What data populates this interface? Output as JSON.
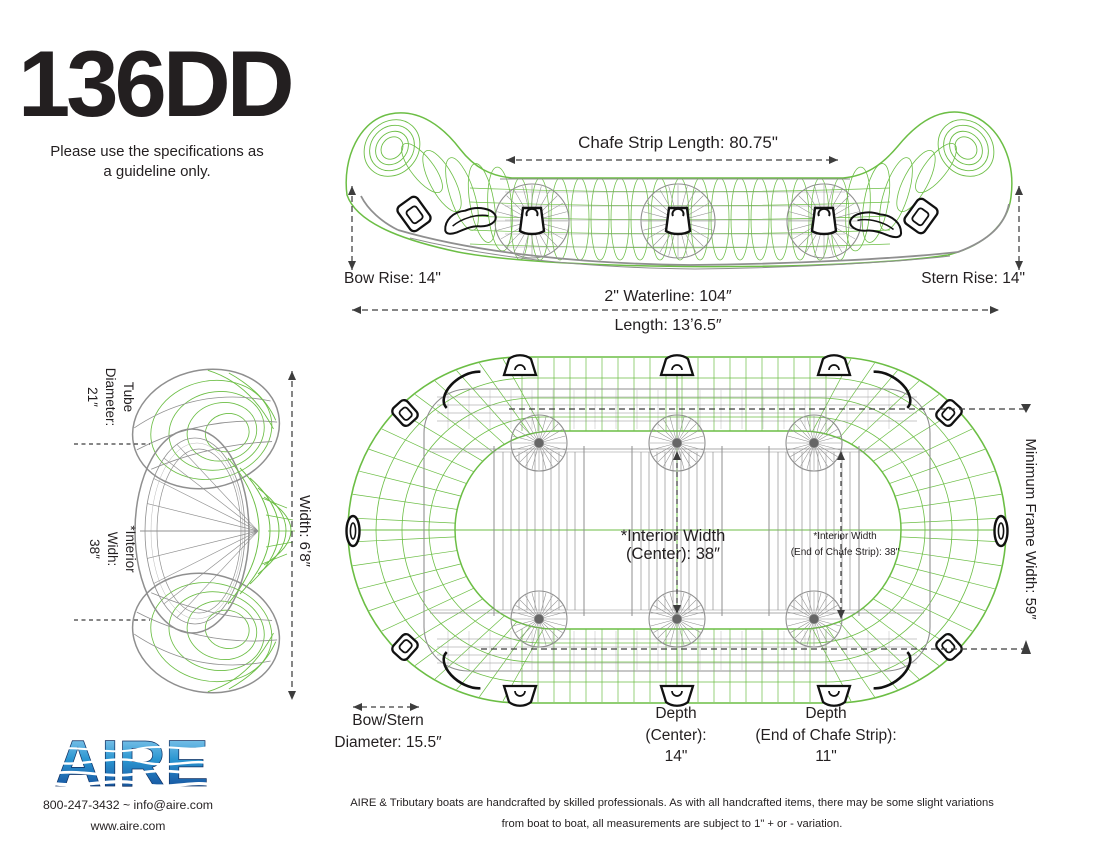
{
  "page": {
    "title": "136DD",
    "subtitle_l1": "Please use the specifications as",
    "subtitle_l2": "a guideline only."
  },
  "side_view": {
    "chafe_strip_length": "Chafe Strip Length: 80.75\"",
    "bow_rise": "Bow Rise: 14\"",
    "stern_rise": "Stern Rise: 14\"",
    "waterline": "2\" Waterline: 104″",
    "length": "Length: 13ʼ6.5″"
  },
  "front_view": {
    "tube_diameter": {
      "l1": "Tube",
      "l2": "Diameter:",
      "l3": "21″"
    },
    "interior_width": {
      "l1": "*Interior",
      "l2": "Widh:",
      "l3": "38″"
    },
    "width": "Width: 6ʼ8″"
  },
  "top_view": {
    "interior_width_center": {
      "l1": "*Interior Width",
      "l2": "(Center): 38″"
    },
    "interior_width_end": {
      "l1": "*Interior Width",
      "l2": "(End of Chafe Strip): 38\""
    },
    "minimum_frame_width": "Minimum Frame Width: 59″",
    "bow_stern_diameter": {
      "l1": "Bow/Stern",
      "l2": "Diameter: 15.5″"
    },
    "depth_center": {
      "l1": "Depth",
      "l2": "(Center):",
      "l3": "14\""
    },
    "depth_end": {
      "l1": "Depth",
      "l2": "(End of Chafe Strip):",
      "l3": "11\""
    }
  },
  "footer": {
    "logo_text": "AIRE",
    "contact": "800-247-3432 ~ info@aire.com",
    "website": "www.aire.com",
    "disclaimer_l1": "AIRE & Tributary boats are handcrafted by skilled professionals.  As with all handcrafted items, there may be some slight variations",
    "disclaimer_l2": "from boat  to boat, all measurements are subject to 1\" + or - variation."
  },
  "colors": {
    "green": "#6cbe45",
    "wire_gray": "#8f8f8f",
    "wire_gray_light": "#b9b9b9",
    "ink": "#231f20",
    "dash": "#3d3d3d",
    "handle_black": "#111111",
    "logo_top": "#aadcf7",
    "logo_mid": "#2b96d1",
    "logo_deep": "#1b62ab",
    "logo_navy": "#16376e"
  }
}
